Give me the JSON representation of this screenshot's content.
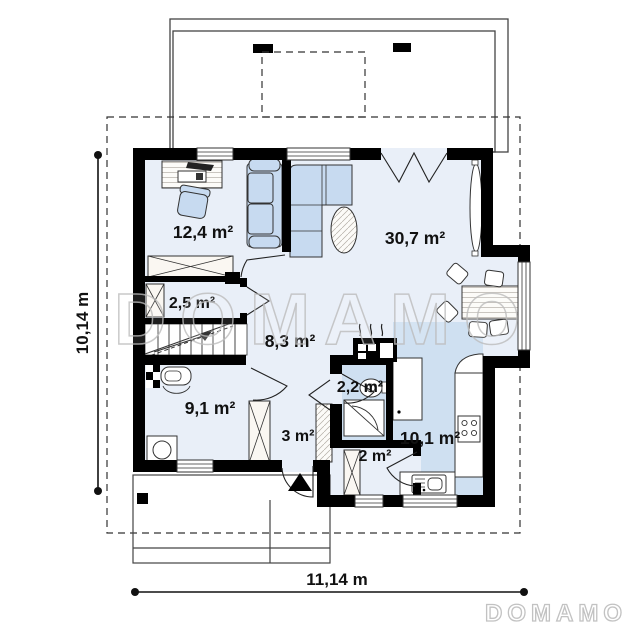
{
  "plan": {
    "rooms": [
      {
        "id": "room-1",
        "label": "12,4 m²"
      },
      {
        "id": "room-2",
        "label": "30,7 m²"
      },
      {
        "id": "room-3",
        "label": "2,5 m²"
      },
      {
        "id": "room-4",
        "label": "8,3 m²"
      },
      {
        "id": "room-5",
        "label": "2,2 m²"
      },
      {
        "id": "room-6",
        "label": "9,1 m²"
      },
      {
        "id": "room-7",
        "label": "3 m²"
      },
      {
        "id": "room-8",
        "label": "2 m²"
      },
      {
        "id": "room-9",
        "label": "10,1 m²"
      }
    ],
    "dimensions": {
      "height": "10,14 m",
      "width": "11,14 m"
    },
    "watermark": "DOMAMO",
    "logo": "DOMAMO",
    "colors": {
      "wall": "#000000",
      "floor": "#e9eff8",
      "wet_floor": "#cfe0f1",
      "furniture": "#c7daf0",
      "watermark": "#bdbdbd"
    }
  }
}
